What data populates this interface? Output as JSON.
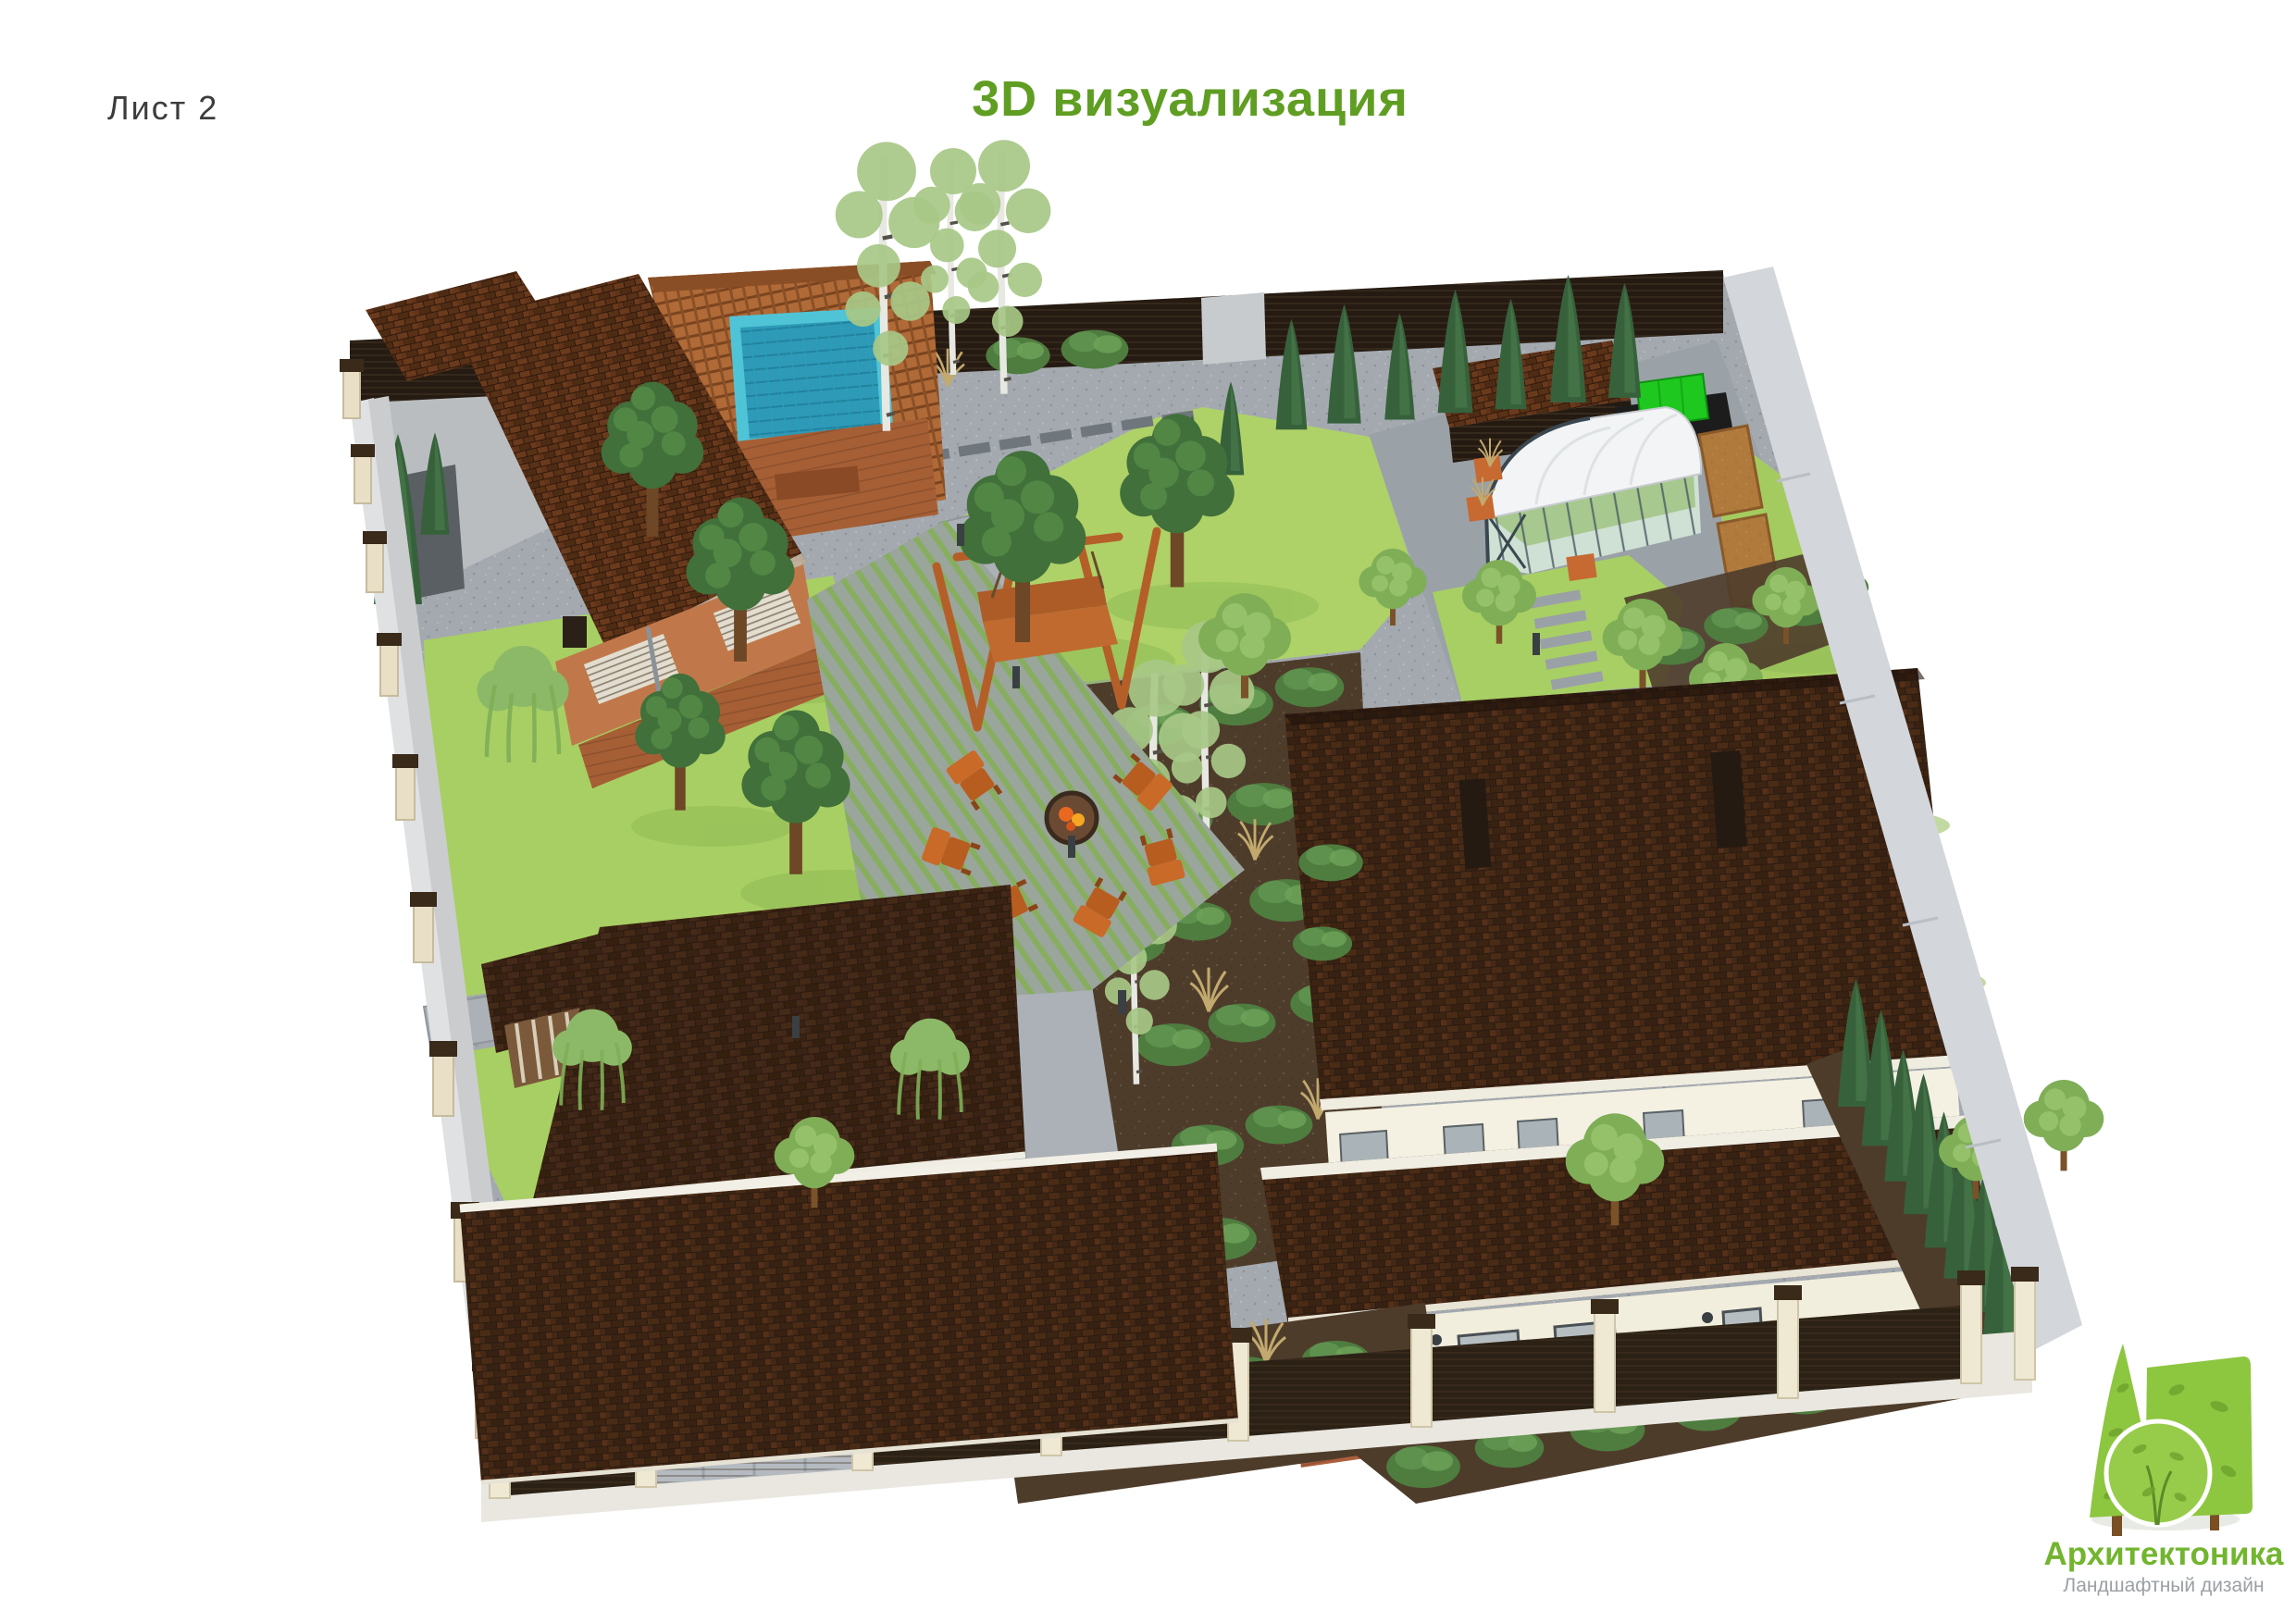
{
  "header": {
    "sheet_label": "Лист 2",
    "title": "3D визуализация",
    "title_color": "#5f9e22"
  },
  "logo": {
    "company": "Архитектоника",
    "tagline": "Ландшафтный дизайн",
    "brand_green": "#72b52e",
    "tagline_color": "#9aa0a4",
    "tree_green": "#8dc63f",
    "trunk_brown": "#7a4f23"
  },
  "scene": {
    "type": "3d-landscape-visualization",
    "colors": {
      "roof_dark": "#332114",
      "roof_red_banya": "#5a3018",
      "paving_gravel": "#a3a9af",
      "path_smooth": "#abb1b6",
      "lawn": "#a8cf63",
      "soil_bed": "#4e3c2b",
      "pool_water": "#2e9ab8",
      "pool_rim": "#4fc4d6",
      "fence_panel_dark": "#2c2115",
      "fence_post_cream": "#efe8d2",
      "fence_outer_gray": "#d3d6da",
      "wood_wall": "#c0784a",
      "deck_wood": "#a65f35",
      "garden_furniture": "#c96a28",
      "septic_tank": "#1ec81e",
      "greenhouse_glass": "#cfe0d4",
      "house_wall": "#f2eedd",
      "house_plinth": "#b06040"
    },
    "objects": [
      "perimeter fence with dark panels",
      "banya with red tiled roof",
      "pergola with hot tub pool",
      "wooden swing bench",
      "fire pit with six chairs",
      "striped deck patio",
      "lawns with pines and birches",
      "arched greenhouse",
      "garden shed",
      "green septic tank",
      "raised vegetable beds",
      "stepping stone paths",
      "garage with two tiled roofs",
      "main house with hipped tile roof and chimneys",
      "thuja hedge along fence",
      "mixed shrub borders",
      "driveway gate",
      "path lighting bollards"
    ]
  }
}
